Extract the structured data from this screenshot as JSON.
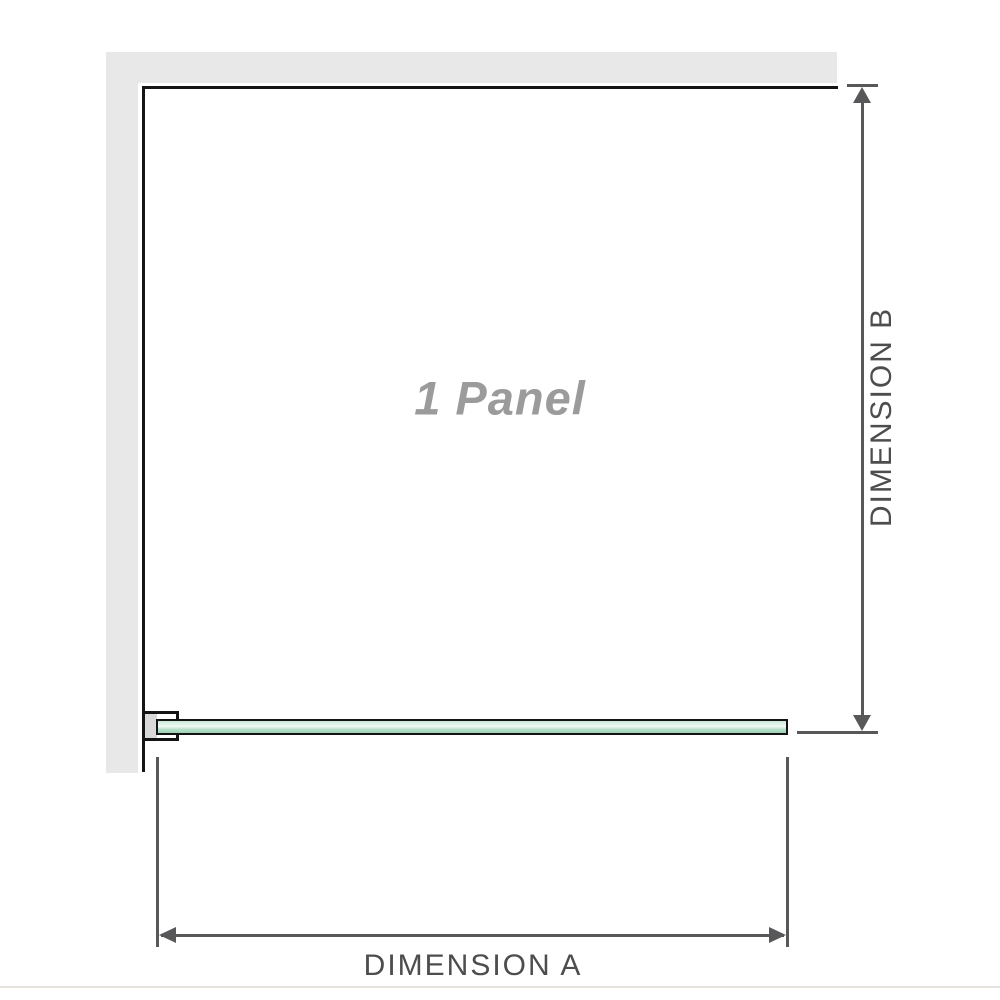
{
  "diagram": {
    "labels": {
      "panel_watermark": "1 Panel",
      "dimension_a": "DIMENSION A",
      "dimension_b": "DIMENSION B"
    },
    "colors": {
      "wall_gray": "#e8e8e8",
      "panel_outline": "#151515",
      "glass_green": "#a9dcc3",
      "glass_highlight": "#f0faf4",
      "dimension_line": "#58585b",
      "dimension_text": "#4d4d4d",
      "watermark_text": "#9b9b9b",
      "bracket_insert_gray": "#d8d8d8",
      "page_edge_line": "#e7e3df"
    }
  }
}
